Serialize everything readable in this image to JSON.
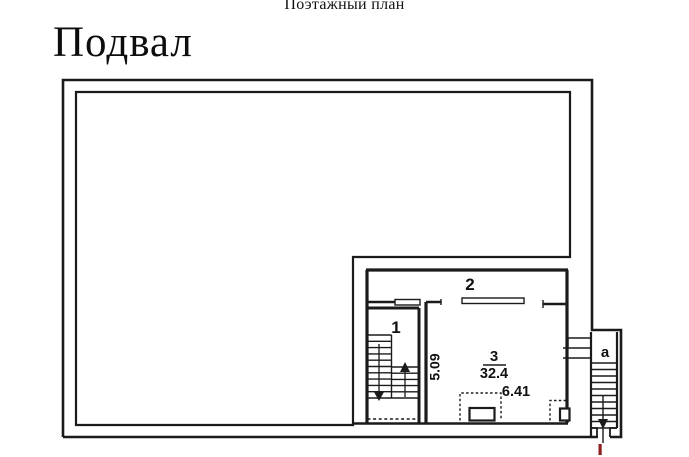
{
  "document": {
    "header_title": "Поэтажный план",
    "floor_title": "Подвал"
  },
  "plan": {
    "rooms": [
      {
        "key": "room-1",
        "label": "1"
      },
      {
        "key": "room-2",
        "label": "2"
      },
      {
        "key": "room-3",
        "label": "3",
        "area": "32.4"
      },
      {
        "key": "annex-a",
        "label": "a"
      }
    ],
    "dimensions": {
      "room3_depth_m": "5.09",
      "room3_width_m": "6.41"
    },
    "colors": {
      "line": "#1b1b1b",
      "entrance_mark": "#8e2020",
      "paper": "#ffffff"
    }
  }
}
